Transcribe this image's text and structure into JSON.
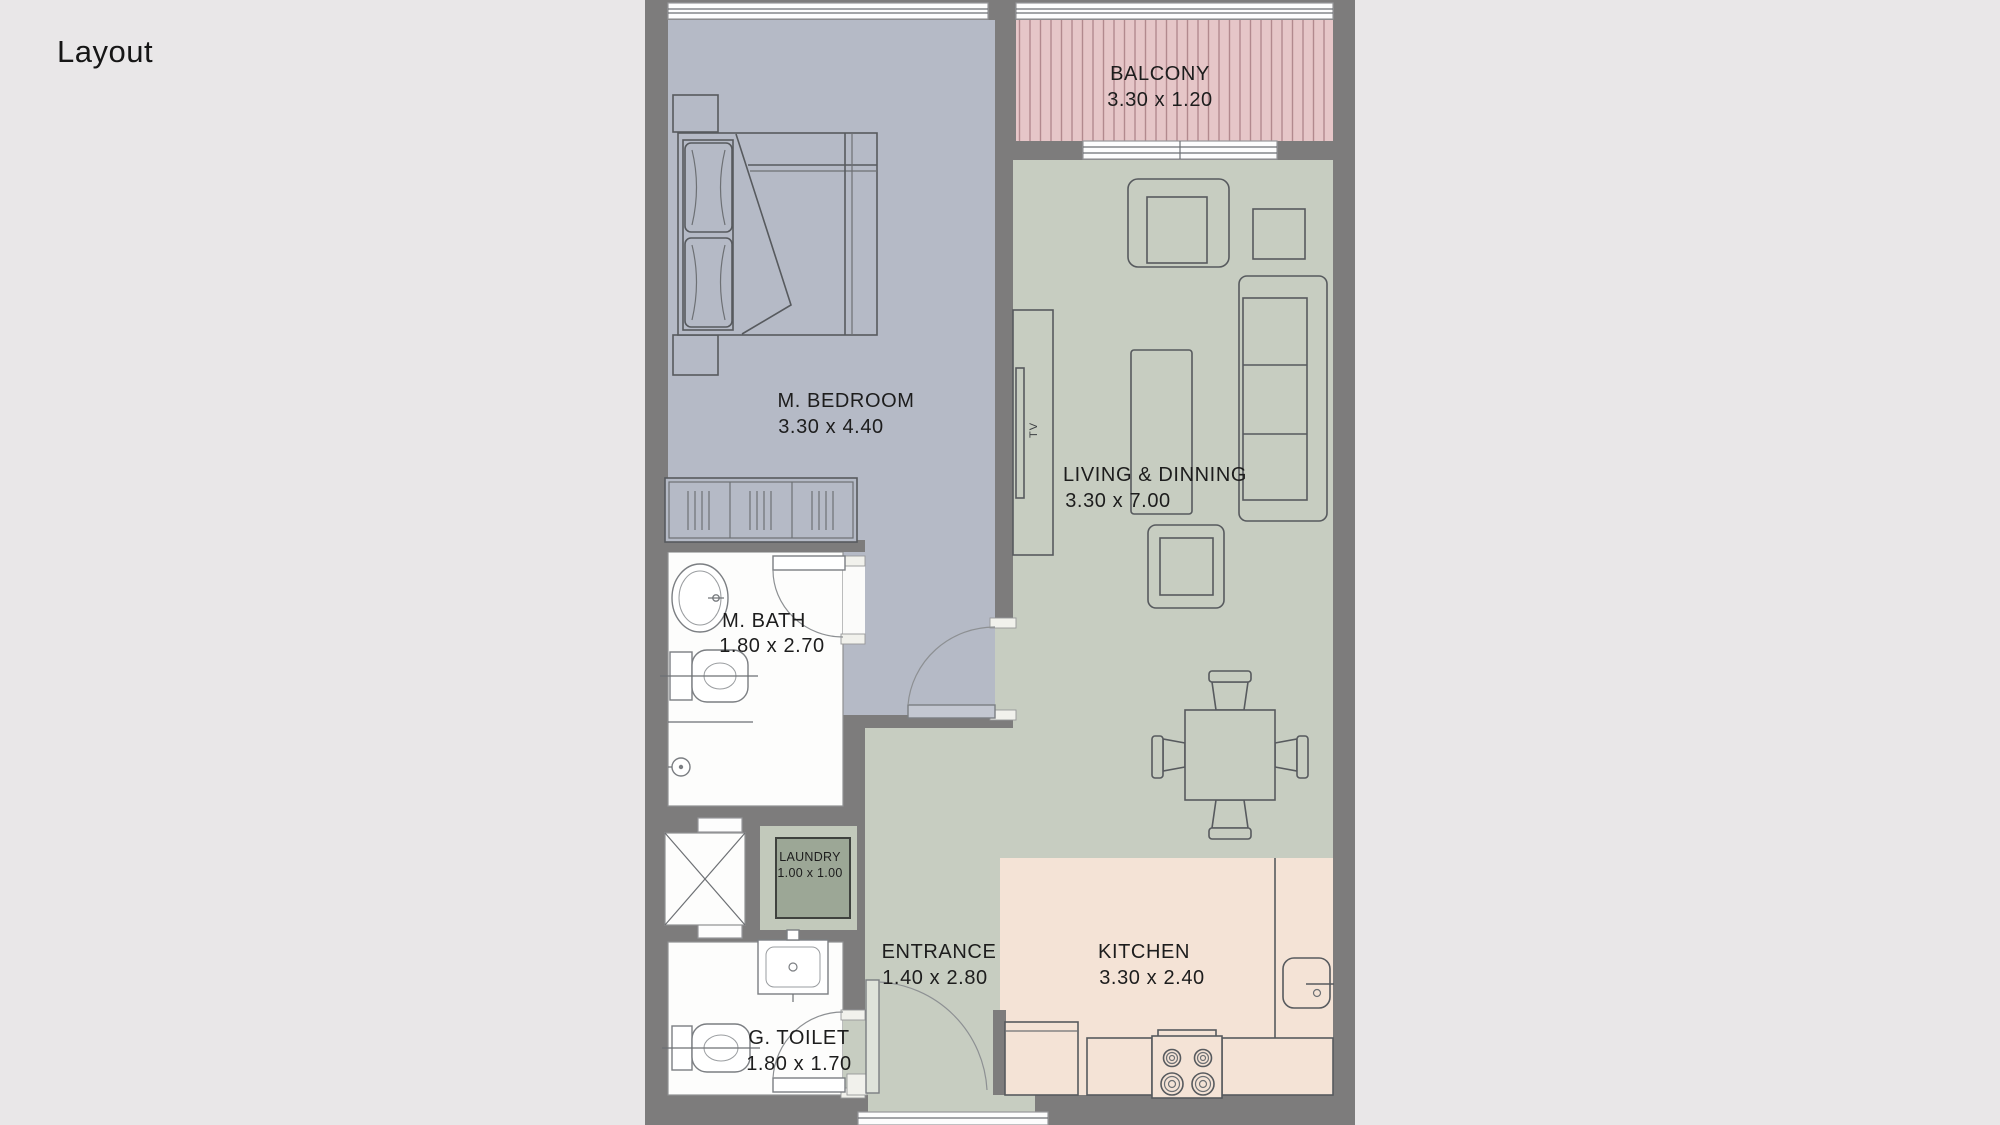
{
  "page": {
    "title": "Layout"
  },
  "palette": {
    "background": "#e9e7e8",
    "wall": "#7d7c7c",
    "bedroom_floor": "#b5bac6",
    "living_floor": "#c7cdc1",
    "balcony_floor": "#e6c6c8",
    "balcony_stripe": "#b2898e",
    "kitchen_floor": "#f4e3d6",
    "laundry_box": "#9ca796",
    "wet_room_floor": "#fefefe",
    "label_text": "#1d1d1d"
  },
  "rooms": [
    {
      "name": "BALCONY",
      "dims": "3.30 x 1.20"
    },
    {
      "name": "M. BEDROOM",
      "dims": "3.30 x 4.40"
    },
    {
      "name": "LIVING & DINNING",
      "dims": "3.30 x 7.00"
    },
    {
      "name": "M. BATH",
      "dims": "1.80 x 2.70"
    },
    {
      "name": "LAUNDRY",
      "dims": "1.00 x 1.00"
    },
    {
      "name": "ENTRANCE",
      "dims": "1.40 x 2.80"
    },
    {
      "name": "KITCHEN",
      "dims": "3.30 x 2.40"
    },
    {
      "name": "G. TOILET",
      "dims": "1.80 x 1.70"
    }
  ],
  "labels": {
    "tv": "TV"
  }
}
